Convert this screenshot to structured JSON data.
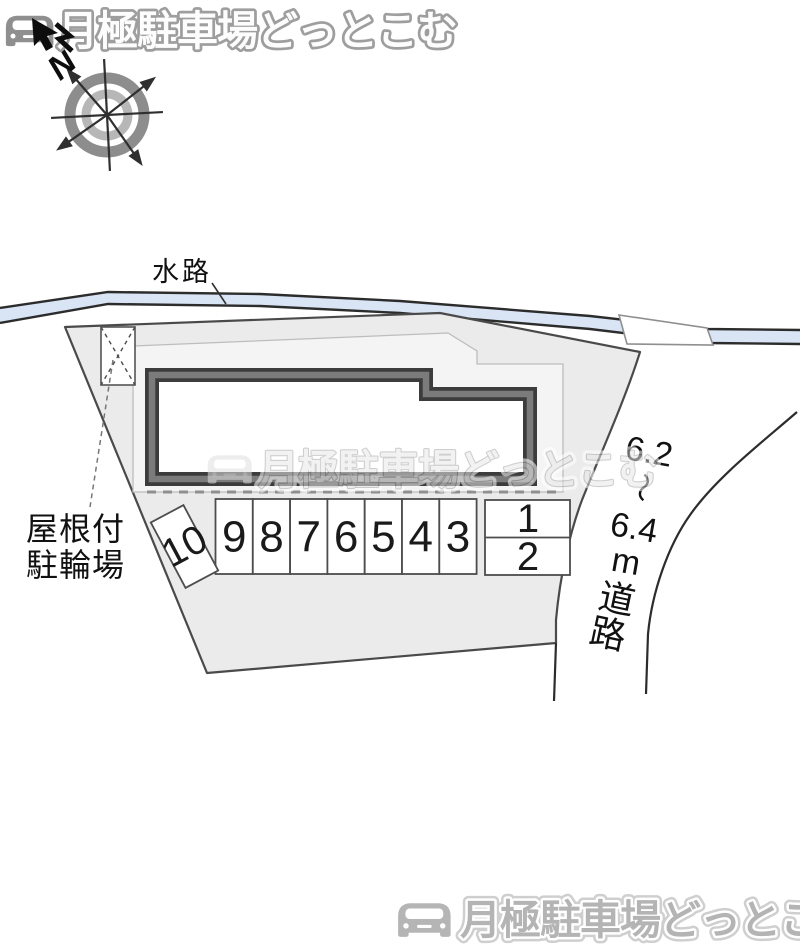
{
  "brand": {
    "logo_text": "月極駐車場どっとこむ"
  },
  "compass": {
    "north_label": "N"
  },
  "map": {
    "waterway_label": "水路",
    "bike_shed_label": {
      "line1": "屋根付",
      "line2": "駐輪場"
    },
    "road_label": {
      "width_min": "6.2",
      "tilde": "〜",
      "width_max": "6.4",
      "unit": "m",
      "road_char_1": "道",
      "road_char_2": "路"
    },
    "stalls": {
      "row": [
        "9",
        "8",
        "7",
        "6",
        "5",
        "4",
        "3"
      ],
      "right_top": "1",
      "right_bottom": "2",
      "rotated": "10"
    }
  },
  "watermark": {
    "text": "月極駐車場どっとこむ"
  },
  "footer": {
    "logo_text": "月極駐車場どっとこむ"
  },
  "colors": {
    "waterway_fill": "#d9e4f4",
    "plot_fill": "#ebebeb",
    "inner_fill": "#f4f4f4",
    "building_border": "#3c3c3c",
    "building_core": "#7b7b7b",
    "line_dark": "#2c2c2c",
    "logo_gray": "#b4b4b4"
  }
}
